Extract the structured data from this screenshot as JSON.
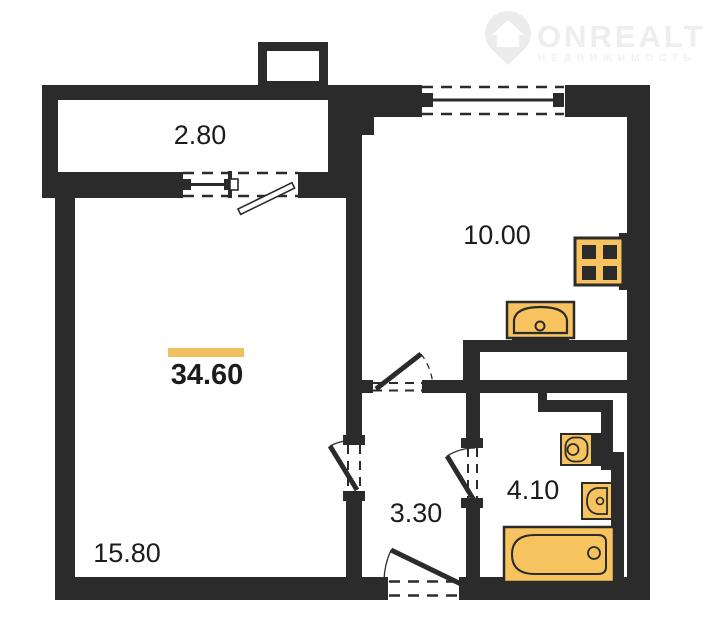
{
  "brand": {
    "name": "ONREALT",
    "tagline": "НЕДВИЖИМОСТЬ",
    "watermark_color": "#eeeeee"
  },
  "plan": {
    "total_area": "34.60",
    "rooms": [
      {
        "name": "balcony",
        "area": "2.80"
      },
      {
        "name": "kitchen",
        "area": "10.00"
      },
      {
        "name": "living-room",
        "area": "15.80"
      },
      {
        "name": "hallway",
        "area": "3.30"
      },
      {
        "name": "bathroom",
        "area": "4.10"
      }
    ]
  },
  "colors": {
    "wall": "#2b2b2b",
    "fixture_fill": "#f6c35f",
    "accent_bar": "#f0c05e",
    "background": "#ffffff"
  },
  "icons": [
    "map-pin-icon",
    "stove-icon",
    "kitchen-sink-icon",
    "toilet-icon",
    "bath-sink-icon",
    "bathtub-icon"
  ]
}
